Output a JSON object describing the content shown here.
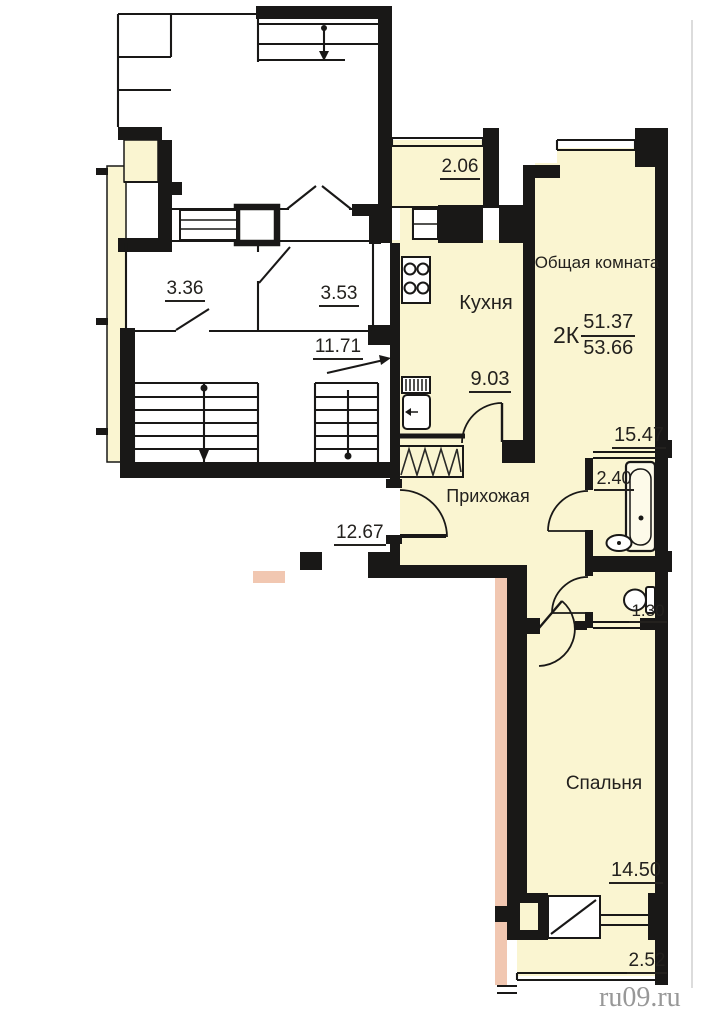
{
  "floor_plan": {
    "apartment": {
      "type": "2К",
      "living_area": "51.37",
      "total_area": "53.66",
      "rooms": {
        "loggia": {
          "area": "2.06"
        },
        "kitchen": {
          "name": "Кухня",
          "area": "9.03"
        },
        "living_room": {
          "name": "Общая комната",
          "area": "15.47"
        },
        "hallway": {
          "name": "Прихожая",
          "area": "12.67"
        },
        "bathroom": {
          "area": "2.40"
        },
        "wc": {
          "area": "1.30"
        },
        "bedroom": {
          "name": "Спальня",
          "area": "14.50"
        },
        "balcony": {
          "area": "2.52"
        }
      }
    },
    "stairwell": {
      "room_a_area": "3.36",
      "room_b_area": "3.53",
      "landing_area": "11.71"
    },
    "watermark": "ru09.ru",
    "colors": {
      "room_fill": "#faf5d1",
      "wall": "#191817",
      "neighbor_wall": "#f1c7b1",
      "text": "#23211e",
      "watermark_text": "#8d8d8d"
    }
  }
}
